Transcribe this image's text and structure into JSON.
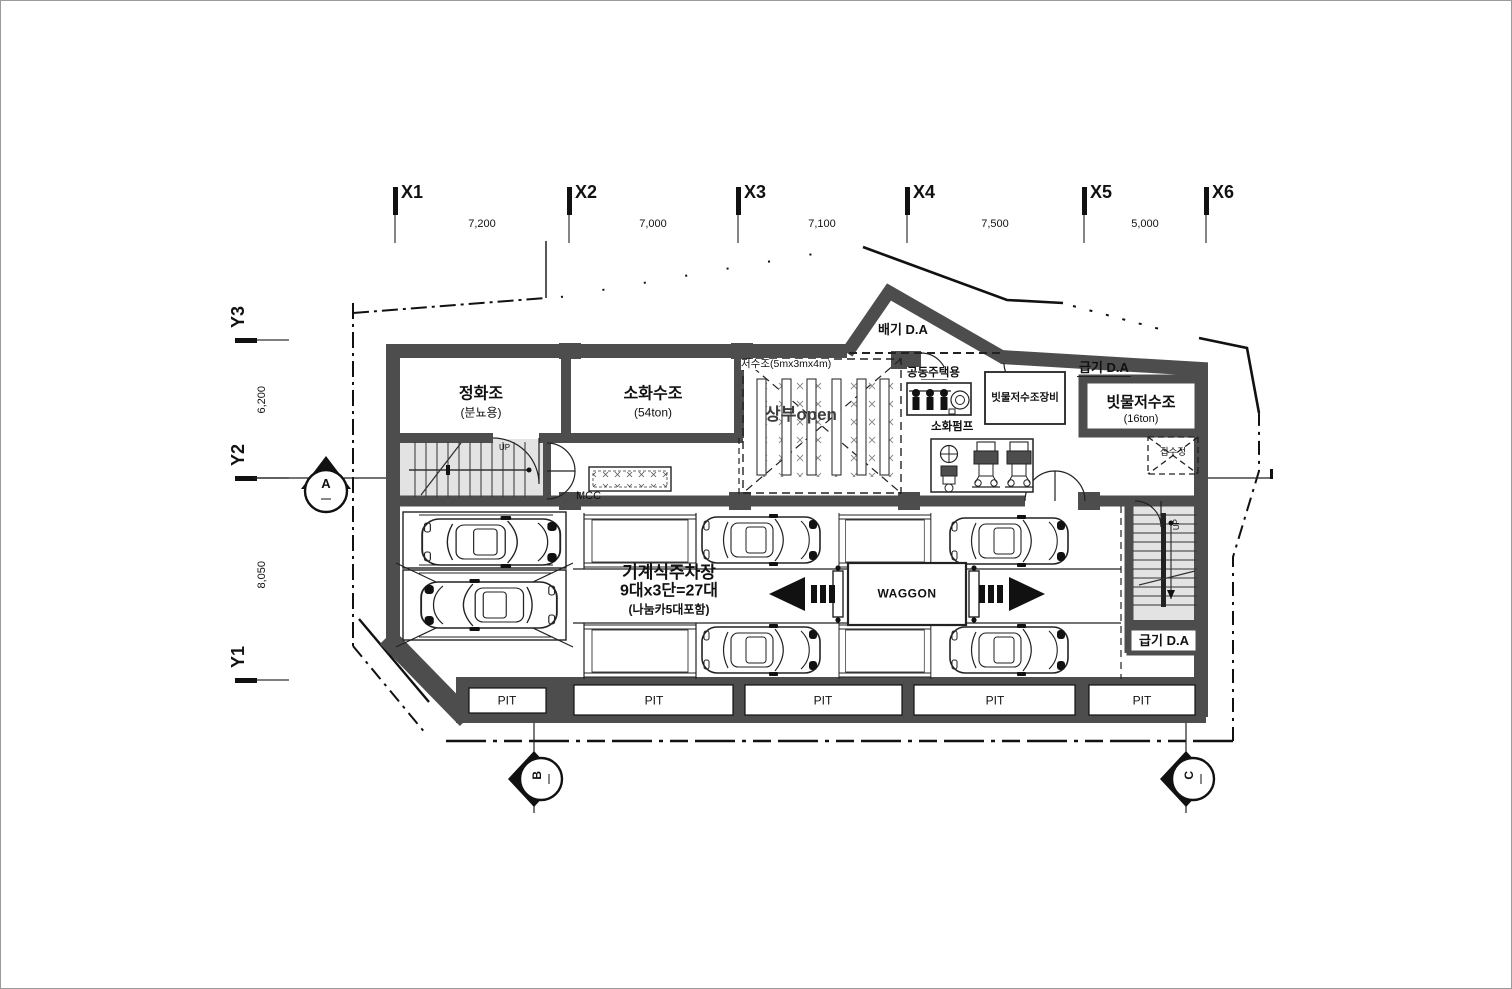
{
  "grid": {
    "x": [
      {
        "label": "X1"
      },
      {
        "label": "X2"
      },
      {
        "label": "X3"
      },
      {
        "label": "X4"
      },
      {
        "label": "X5"
      },
      {
        "label": "X6"
      }
    ],
    "x_dims": [
      "7,200",
      "7,000",
      "7,100",
      "7,500",
      "5,000"
    ],
    "y": [
      {
        "label": "Y3"
      },
      {
        "label": "Y2"
      },
      {
        "label": "Y1"
      }
    ],
    "y_dims": [
      "6,200",
      "8,050"
    ]
  },
  "rooms": {
    "septic_name": "정화조",
    "septic_sub": "(분뇨용)",
    "fire_tank_name": "소화수조",
    "fire_tank_sub": "(54ton)",
    "rain_tank_name": "빗물저수조",
    "rain_tank_sub": "(16ton)"
  },
  "labels": {
    "exhaust_da": "배기 D.A",
    "supply_da_top": "급기 D.A",
    "supply_da_bottom": "급기 D.A",
    "reservoir": "저수조(5mx3mx4m)",
    "open_above": "상부open",
    "apartment": "공동주택용",
    "rain_equipment": "빗물저수조장비",
    "fire_pump": "소화펌프",
    "mcc": "MCC",
    "sump": "집수정",
    "up_left": "UP",
    "up_right": "UP",
    "waggon": "WAGGON"
  },
  "pits": [
    "PIT",
    "PIT",
    "PIT",
    "PIT",
    "PIT"
  ],
  "parking": {
    "line1": "기계식주차장",
    "line2": "9대x3단=27대",
    "line3": "(나눔카5대포함)"
  },
  "markers": {
    "a": "A",
    "b": "B",
    "c": "C"
  },
  "colors": {
    "wall": "#4d4d4d",
    "stair_fill": "#e3e3e3",
    "line": "#1a1a1a"
  }
}
